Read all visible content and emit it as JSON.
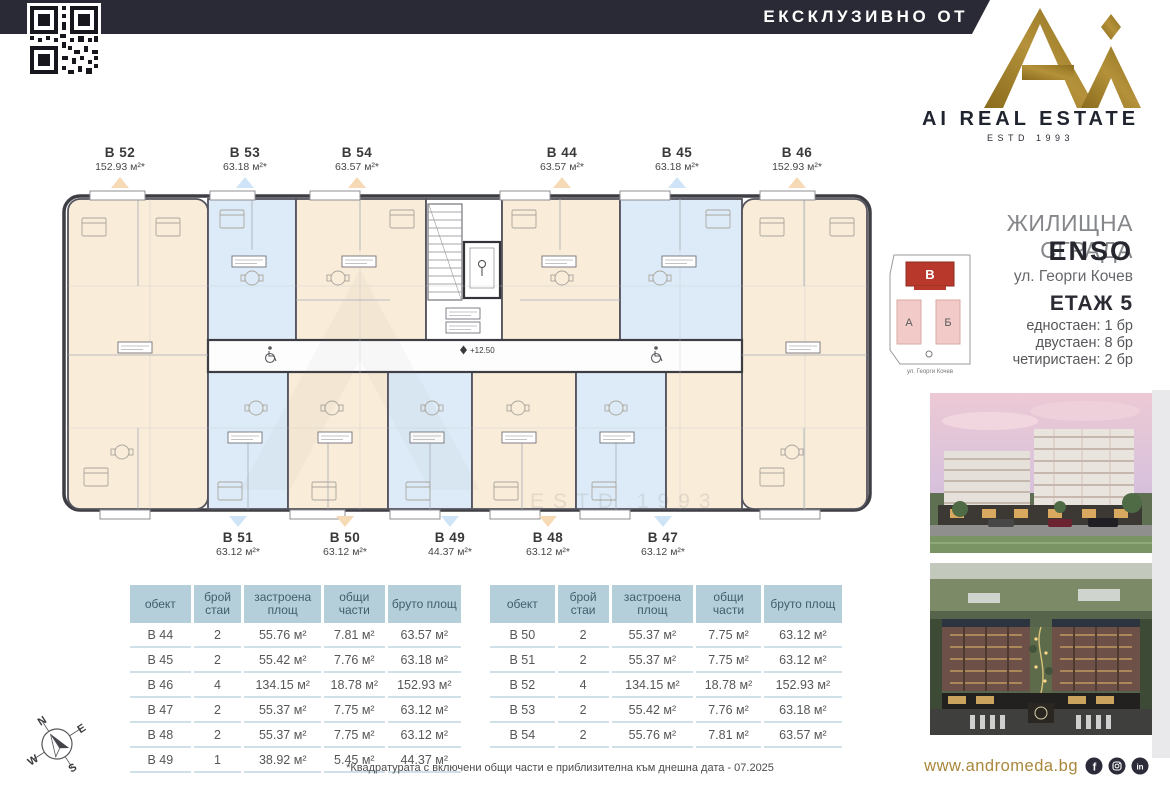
{
  "top_bar": {
    "exclusive_label": "ЕКСКЛУЗИВНО ОТ"
  },
  "brand": {
    "name": "AI REAL ESTATE",
    "estd": "ESTD 1993"
  },
  "panel": {
    "building_type": "ЖИЛИЩНА СГРАДА",
    "building_name": "ENSO",
    "address": "ул. Георги Кочев",
    "floor_label": "ЕТАЖ 5",
    "unit_mix": [
      "едностаен: 1 бр",
      "двустаен: 8 бр",
      "четиристаен: 2 бр"
    ],
    "site_plan": {
      "block_b": "В",
      "block_a": "А",
      "block_mid": "Б",
      "street": "ул. Георги Кочев"
    }
  },
  "floor_plan": {
    "elevation": "+12.50",
    "watermark": "ESTD 1993",
    "top_units": [
      {
        "id": "B 52",
        "area": "152.93 м²*",
        "accent": "peach"
      },
      {
        "id": "B 53",
        "area": "63.18 м²*",
        "accent": "blue"
      },
      {
        "id": "B 54",
        "area": "63.57 м²*",
        "accent": "peach"
      },
      {
        "id": "B 44",
        "area": "63.57 м²*",
        "accent": "peach"
      },
      {
        "id": "B 45",
        "area": "63.18 м²*",
        "accent": "blue"
      },
      {
        "id": "B 46",
        "area": "152.93 м²*",
        "accent": "peach"
      }
    ],
    "bottom_units": [
      {
        "id": "B 51",
        "area": "63.12 м²*",
        "accent": "blue"
      },
      {
        "id": "B 50",
        "area": "63.12 м²*",
        "accent": "peach"
      },
      {
        "id": "B 49",
        "area": "44.37 м²*",
        "accent": "blue"
      },
      {
        "id": "B 48",
        "area": "63.12 м²*",
        "accent": "peach"
      },
      {
        "id": "B 47",
        "area": "63.12 м²*",
        "accent": "blue"
      }
    ]
  },
  "tables": {
    "headers": [
      "обект",
      "брой стаи",
      "застроена площ",
      "общи части",
      "бруто площ"
    ],
    "left_rows": [
      [
        "B 44",
        "2",
        "55.76 м²",
        "7.81 м²",
        "63.57 м²"
      ],
      [
        "B 45",
        "2",
        "55.42 м²",
        "7.76 м²",
        "63.18 м²"
      ],
      [
        "B 46",
        "4",
        "134.15 м²",
        "18.78 м²",
        "152.93 м²"
      ],
      [
        "B 47",
        "2",
        "55.37 м²",
        "7.75 м²",
        "63.12 м²"
      ],
      [
        "B 48",
        "2",
        "55.37 м²",
        "7.75 м²",
        "63.12 м²"
      ],
      [
        "B 49",
        "1",
        "38.92 м²",
        "5.45 м²",
        "44.37 м²"
      ]
    ],
    "right_rows": [
      [
        "B 50",
        "2",
        "55.37 м²",
        "7.75 м²",
        "63.12 м²"
      ],
      [
        "B 51",
        "2",
        "55.37 м²",
        "7.75 м²",
        "63.12 м²"
      ],
      [
        "B 52",
        "4",
        "134.15 м²",
        "18.78 м²",
        "152.93 м²"
      ],
      [
        "B 53",
        "2",
        "55.42 м²",
        "7.76 м²",
        "63.18 м²"
      ],
      [
        "B 54",
        "2",
        "55.76 м²",
        "7.81 м²",
        "63.57 м²"
      ]
    ]
  },
  "footnote": "*Квадратурата с включени общи части е приблизителна към днешна дата - 07.2025",
  "footer": {
    "website": "www.andromeda.bg"
  },
  "compass": {
    "n": "N",
    "e": "E",
    "s": "S",
    "w": "W"
  },
  "colors": {
    "navy": "#2a2a37",
    "gold": "#a0802e",
    "cream_unit": "#f9ecd9",
    "blue_unit": "#dcebf7",
    "red_block": "#b8392c",
    "table_header": "#b5cfda"
  }
}
